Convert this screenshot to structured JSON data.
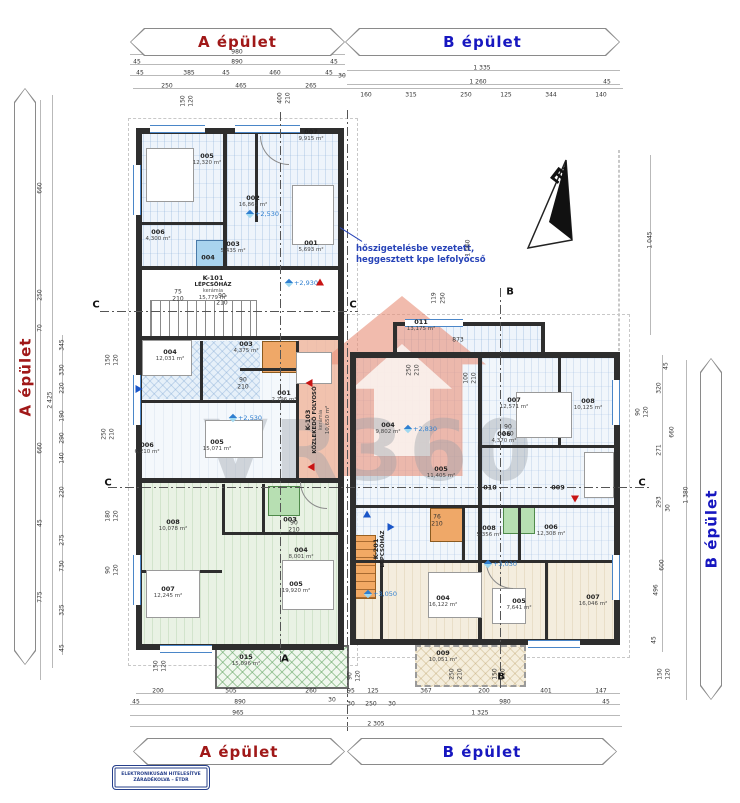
{
  "banners": {
    "a": "A épület",
    "b": "B épület",
    "a_color": "#a01818",
    "b_color": "#1717c0"
  },
  "north_label": "É",
  "annotation": {
    "line1": "hőszigetelésbe vezetett,",
    "line2": "heggesztett kpe lefolyócső"
  },
  "watermark": "VR360",
  "stamp": {
    "line1": "ELEKTRONIKUSAN HITELESÍTVE",
    "line2": "ZÁRADÉKOLVA – ÉTDR"
  },
  "colors": {
    "accent_red": "#a01818",
    "accent_blue": "#1717c0",
    "level_blue": "#2f7fd0",
    "watermark_orange": "#e8927a"
  },
  "rooms": [
    {
      "id": "005",
      "area": "12,320 m²",
      "x": 207,
      "y": 160
    },
    {
      "id": "007",
      "area": "9,915 m²",
      "x": 311,
      "y": 136
    },
    {
      "id": "002",
      "area": "16,861 m²",
      "x": 253,
      "y": 202
    },
    {
      "id": "006",
      "area": "4,300 m²",
      "x": 158,
      "y": 236
    },
    {
      "id": "003",
      "area": "5,435 m²",
      "x": 233,
      "y": 248
    },
    {
      "id": "001",
      "area": "5,693 m²",
      "x": 311,
      "y": 247
    },
    {
      "id": "004",
      "x": 208,
      "y": 258
    },
    {
      "id": "K-101",
      "name": "LÉPCSŐHÁZ",
      "mat": "kerámia",
      "area": "15,779 m²",
      "x": 213,
      "y": 288
    },
    {
      "id": "004",
      "area": "12,031 m²",
      "x": 170,
      "y": 356
    },
    {
      "id": "003",
      "area": "4,375 m²",
      "x": 246,
      "y": 348
    },
    {
      "id": "001",
      "area": "2,796 m²",
      "x": 284,
      "y": 397
    },
    {
      "id": "005",
      "area": "15,071 m²",
      "x": 217,
      "y": 446
    },
    {
      "id": "006",
      "area": "6,210 m²",
      "x": 147,
      "y": 449
    },
    {
      "id": "K-103",
      "name": "KÖZLEKEDŐ FOLYOSÓ",
      "mat": "kerámia",
      "area": "10,650 m²",
      "x": 318,
      "y": 420,
      "v": 1
    },
    {
      "id": "008",
      "area": "10,078 m²",
      "x": 173,
      "y": 526
    },
    {
      "id": "003",
      "x": 290,
      "y": 520
    },
    {
      "id": "004",
      "area": "8,001 m²",
      "x": 301,
      "y": 554
    },
    {
      "id": "005",
      "area": "19,920 m²",
      "x": 296,
      "y": 588
    },
    {
      "id": "007",
      "area": "12,245 m²",
      "x": 168,
      "y": 593
    },
    {
      "id": "015",
      "area": "15,096 m²",
      "x": 246,
      "y": 661
    },
    {
      "id": "011",
      "area": "13,175 m²",
      "x": 421,
      "y": 326
    },
    {
      "id": "004",
      "area": "9,802 m²",
      "x": 388,
      "y": 429
    },
    {
      "id": "007",
      "area": "12,571 m²",
      "x": 514,
      "y": 404
    },
    {
      "id": "008",
      "area": "10,125 m²",
      "x": 588,
      "y": 405
    },
    {
      "id": "005",
      "area": "11,405 m²",
      "x": 441,
      "y": 473
    },
    {
      "id": "006",
      "area": "4,370 m²",
      "x": 504,
      "y": 438
    },
    {
      "id": "010",
      "x": 490,
      "y": 488
    },
    {
      "id": "009",
      "x": 558,
      "y": 488
    },
    {
      "id": "K-201",
      "name": "LÉPCSŐHÁZ",
      "x": 380,
      "y": 549,
      "v": 1
    },
    {
      "id": "008",
      "area": "5,356 m²",
      "x": 489,
      "y": 532
    },
    {
      "id": "006",
      "area": "12,308 m²",
      "x": 551,
      "y": 531
    },
    {
      "id": "004",
      "area": "16,122 m²",
      "x": 443,
      "y": 602
    },
    {
      "id": "005",
      "area": "7,641 m²",
      "x": 519,
      "y": 605
    },
    {
      "id": "007",
      "area": "16,046 m²",
      "x": 593,
      "y": 601
    },
    {
      "id": "009",
      "area": "10,051 m²",
      "x": 443,
      "y": 657
    }
  ],
  "dims": [
    {
      "t": "980",
      "x": 237,
      "y": 52
    },
    {
      "t": "45",
      "x": 137,
      "y": 62
    },
    {
      "t": "890",
      "x": 237,
      "y": 62
    },
    {
      "t": "45",
      "x": 334,
      "y": 62
    },
    {
      "t": "45",
      "x": 140,
      "y": 73
    },
    {
      "t": "385",
      "x": 189,
      "y": 73
    },
    {
      "t": "45",
      "x": 226,
      "y": 73
    },
    {
      "t": "460",
      "x": 275,
      "y": 73
    },
    {
      "t": "45",
      "x": 329,
      "y": 73
    },
    {
      "t": "30",
      "x": 342,
      "y": 76
    },
    {
      "t": "250",
      "x": 167,
      "y": 86
    },
    {
      "t": "465",
      "x": 241,
      "y": 86
    },
    {
      "t": "265",
      "x": 311,
      "y": 86
    },
    {
      "t": "150",
      "x": 183,
      "y": 101,
      "v": 1
    },
    {
      "t": "120",
      "x": 191,
      "y": 101,
      "v": 1
    },
    {
      "t": "400",
      "x": 280,
      "y": 98,
      "v": 1
    },
    {
      "t": "210",
      "x": 288,
      "y": 98,
      "v": 1
    },
    {
      "t": "1 335",
      "x": 482,
      "y": 68
    },
    {
      "t": "1 260",
      "x": 478,
      "y": 82
    },
    {
      "t": "45",
      "x": 607,
      "y": 82
    },
    {
      "t": "160",
      "x": 366,
      "y": 95
    },
    {
      "t": "315",
      "x": 411,
      "y": 95
    },
    {
      "t": "250",
      "x": 466,
      "y": 95
    },
    {
      "t": "125",
      "x": 506,
      "y": 95
    },
    {
      "t": "344",
      "x": 551,
      "y": 95
    },
    {
      "t": "140",
      "x": 601,
      "y": 95
    },
    {
      "t": "1 060",
      "x": 468,
      "y": 248,
      "v": 1
    },
    {
      "t": "119",
      "x": 434,
      "y": 298,
      "v": 1
    },
    {
      "t": "250",
      "x": 443,
      "y": 298,
      "v": 1
    },
    {
      "t": "873",
      "x": 458,
      "y": 340
    },
    {
      "t": "250",
      "x": 409,
      "y": 370,
      "v": 1
    },
    {
      "t": "210",
      "x": 417,
      "y": 370,
      "v": 1
    },
    {
      "t": "100",
      "x": 466,
      "y": 378,
      "v": 1
    },
    {
      "t": "210",
      "x": 474,
      "y": 378,
      "v": 1
    },
    {
      "t": "200",
      "x": 158,
      "y": 691
    },
    {
      "t": "505",
      "x": 231,
      "y": 691
    },
    {
      "t": "260",
      "x": 311,
      "y": 691
    },
    {
      "t": "95",
      "x": 351,
      "y": 691
    },
    {
      "t": "125",
      "x": 373,
      "y": 691
    },
    {
      "t": "367",
      "x": 426,
      "y": 691
    },
    {
      "t": "200",
      "x": 484,
      "y": 691
    },
    {
      "t": "401",
      "x": 546,
      "y": 691
    },
    {
      "t": "147",
      "x": 601,
      "y": 691
    },
    {
      "t": "45",
      "x": 136,
      "y": 702
    },
    {
      "t": "890",
      "x": 240,
      "y": 702
    },
    {
      "t": "30",
      "x": 332,
      "y": 700
    },
    {
      "t": "30",
      "x": 351,
      "y": 704
    },
    {
      "t": "250",
      "x": 371,
      "y": 704
    },
    {
      "t": "30",
      "x": 392,
      "y": 704
    },
    {
      "t": "980",
      "x": 505,
      "y": 702
    },
    {
      "t": "45",
      "x": 606,
      "y": 702
    },
    {
      "t": "965",
      "x": 238,
      "y": 713
    },
    {
      "t": "1 325",
      "x": 480,
      "y": 713
    },
    {
      "t": "2 305",
      "x": 376,
      "y": 724
    },
    {
      "t": "150",
      "x": 156,
      "y": 666,
      "v": 1
    },
    {
      "t": "120",
      "x": 164,
      "y": 666,
      "v": 1
    },
    {
      "t": "90",
      "x": 350,
      "y": 676,
      "v": 1
    },
    {
      "t": "120",
      "x": 358,
      "y": 676,
      "v": 1
    },
    {
      "t": "250",
      "x": 452,
      "y": 674,
      "v": 1
    },
    {
      "t": "210",
      "x": 460,
      "y": 674,
      "v": 1
    },
    {
      "t": "150",
      "x": 495,
      "y": 674,
      "v": 1
    },
    {
      "t": "120",
      "x": 503,
      "y": 674,
      "v": 1
    },
    {
      "t": "150",
      "x": 660,
      "y": 674,
      "v": 1
    },
    {
      "t": "120",
      "x": 668,
      "y": 674,
      "v": 1
    },
    {
      "t": "660",
      "x": 40,
      "y": 188,
      "v": 1
    },
    {
      "t": "250",
      "x": 40,
      "y": 295,
      "v": 1
    },
    {
      "t": "70",
      "x": 40,
      "y": 328,
      "v": 1
    },
    {
      "t": "660",
      "x": 40,
      "y": 448,
      "v": 1
    },
    {
      "t": "45",
      "x": 40,
      "y": 523,
      "v": 1
    },
    {
      "t": "775",
      "x": 40,
      "y": 597,
      "v": 1
    },
    {
      "t": "2 425",
      "x": 50,
      "y": 400,
      "v": 1
    },
    {
      "t": "345",
      "x": 62,
      "y": 345,
      "v": 1
    },
    {
      "t": "330",
      "x": 62,
      "y": 370,
      "v": 1
    },
    {
      "t": "220",
      "x": 62,
      "y": 388,
      "v": 1
    },
    {
      "t": "190",
      "x": 62,
      "y": 416,
      "v": 1
    },
    {
      "t": "290",
      "x": 62,
      "y": 438,
      "v": 1
    },
    {
      "t": "140",
      "x": 62,
      "y": 458,
      "v": 1
    },
    {
      "t": "220",
      "x": 62,
      "y": 492,
      "v": 1
    },
    {
      "t": "275",
      "x": 62,
      "y": 540,
      "v": 1
    },
    {
      "t": "730",
      "x": 62,
      "y": 566,
      "v": 1
    },
    {
      "t": "325",
      "x": 62,
      "y": 610,
      "v": 1
    },
    {
      "t": "45",
      "x": 62,
      "y": 648,
      "v": 1
    },
    {
      "t": "150",
      "x": 108,
      "y": 360,
      "v": 1
    },
    {
      "t": "120",
      "x": 116,
      "y": 360,
      "v": 1
    },
    {
      "t": "250",
      "x": 104,
      "y": 434,
      "v": 1
    },
    {
      "t": "210",
      "x": 112,
      "y": 434,
      "v": 1
    },
    {
      "t": "180",
      "x": 108,
      "y": 516,
      "v": 1
    },
    {
      "t": "120",
      "x": 116,
      "y": 516,
      "v": 1
    },
    {
      "t": "90",
      "x": 108,
      "y": 570,
      "v": 1
    },
    {
      "t": "120",
      "x": 116,
      "y": 570,
      "v": 1
    },
    {
      "t": "1 045",
      "x": 650,
      "y": 240,
      "v": 1
    },
    {
      "t": "45",
      "x": 666,
      "y": 366,
      "v": 1
    },
    {
      "t": "320",
      "x": 659,
      "y": 388,
      "v": 1
    },
    {
      "t": "90",
      "x": 638,
      "y": 412,
      "v": 1
    },
    {
      "t": "120",
      "x": 646,
      "y": 412,
      "v": 1
    },
    {
      "t": "660",
      "x": 672,
      "y": 432,
      "v": 1
    },
    {
      "t": "271",
      "x": 659,
      "y": 450,
      "v": 1
    },
    {
      "t": "1 380",
      "x": 686,
      "y": 495,
      "v": 1
    },
    {
      "t": "293",
      "x": 659,
      "y": 502,
      "v": 1
    },
    {
      "t": "30",
      "x": 668,
      "y": 508,
      "v": 1
    },
    {
      "t": "600",
      "x": 662,
      "y": 565,
      "v": 1
    },
    {
      "t": "496",
      "x": 656,
      "y": 590,
      "v": 1
    },
    {
      "t": "45",
      "x": 654,
      "y": 640,
      "v": 1
    },
    {
      "t": "75",
      "x": 178,
      "y": 292
    },
    {
      "t": "210",
      "x": 178,
      "y": 299
    },
    {
      "t": "90",
      "x": 222,
      "y": 296
    },
    {
      "t": "210",
      "x": 222,
      "y": 303
    },
    {
      "t": "90",
      "x": 243,
      "y": 380
    },
    {
      "t": "210",
      "x": 243,
      "y": 387
    },
    {
      "t": "76",
      "x": 437,
      "y": 517
    },
    {
      "t": "210",
      "x": 437,
      "y": 524
    },
    {
      "t": "90",
      "x": 508,
      "y": 427
    },
    {
      "t": "210",
      "x": 508,
      "y": 434
    },
    {
      "t": "90",
      "x": 294,
      "y": 523
    },
    {
      "t": "210",
      "x": 294,
      "y": 530
    }
  ],
  "levels": [
    {
      "t": "+2,530",
      "x": 263,
      "y": 214
    },
    {
      "t": "+2,930",
      "x": 302,
      "y": 283
    },
    {
      "t": "+2,530",
      "x": 246,
      "y": 418
    },
    {
      "t": "+2,830",
      "x": 421,
      "y": 429
    },
    {
      "t": "+3,030",
      "x": 501,
      "y": 564
    },
    {
      "t": "+3,050",
      "x": 381,
      "y": 594
    }
  ],
  "sections": [
    {
      "t": "C",
      "x": 96,
      "y": 305
    },
    {
      "t": "C",
      "x": 353,
      "y": 305
    },
    {
      "t": "C",
      "x": 108,
      "y": 483
    },
    {
      "t": "C",
      "x": 642,
      "y": 483
    },
    {
      "t": "B",
      "x": 510,
      "y": 292
    },
    {
      "t": "B",
      "x": 501,
      "y": 677
    },
    {
      "t": "A",
      "x": 285,
      "y": 659
    }
  ],
  "arrows": [
    {
      "x": 307,
      "y": 383,
      "cls": "red l"
    },
    {
      "x": 309,
      "y": 467,
      "cls": "red l"
    },
    {
      "x": 320,
      "y": 280,
      "cls": "red u"
    },
    {
      "x": 575,
      "y": 501,
      "cls": "red d"
    },
    {
      "x": 141,
      "y": 389,
      "cls": "blue r"
    },
    {
      "x": 393,
      "y": 527,
      "cls": "blue r"
    },
    {
      "x": 367,
      "y": 512,
      "cls": "blue u"
    }
  ]
}
